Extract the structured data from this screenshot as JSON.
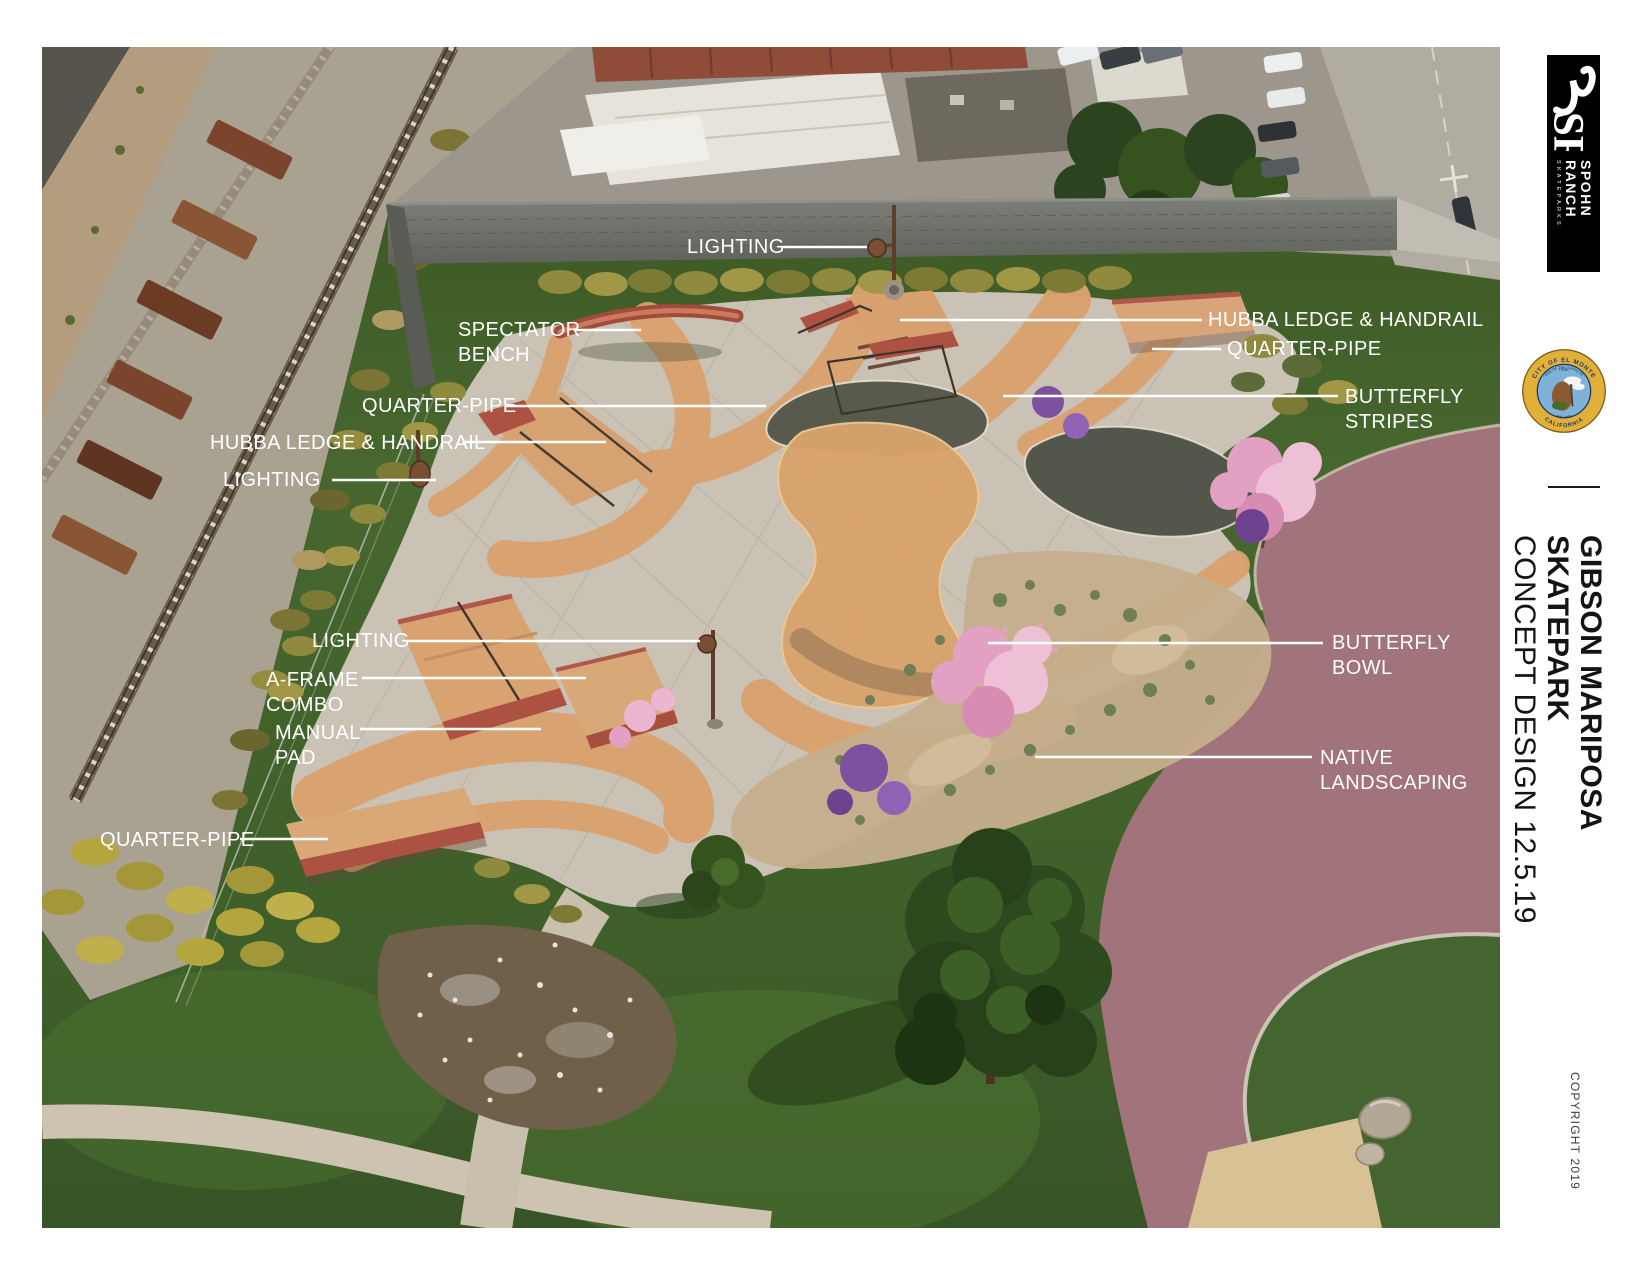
{
  "callouts": [
    {
      "id": "lighting-north",
      "label": "LIGHTING"
    },
    {
      "id": "spectator-bench",
      "label": "SPECTATOR\nBENCH"
    },
    {
      "id": "hubba-ledge-handrail-east",
      "label": "HUBBA LEDGE & HANDRAIL"
    },
    {
      "id": "quarter-pipe-east",
      "label": "QUARTER-PIPE"
    },
    {
      "id": "quarter-pipe-west",
      "label": "QUARTER-PIPE"
    },
    {
      "id": "butterfly-stripes",
      "label": "BUTTERFLY\nSTRIPES"
    },
    {
      "id": "hubba-ledge-handrail-west",
      "label": "HUBBA LEDGE & HANDRAIL"
    },
    {
      "id": "lighting-west",
      "label": "LIGHTING"
    },
    {
      "id": "lighting-south",
      "label": "LIGHTING"
    },
    {
      "id": "a-frame-combo",
      "label": "A-FRAME\nCOMBO"
    },
    {
      "id": "manual-pad",
      "label": "MANUAL\nPAD"
    },
    {
      "id": "butterfly-bowl",
      "label": "BUTTERFLY\nBOWL"
    },
    {
      "id": "native-landscaping",
      "label": "NATIVE\nLANDSCAPING"
    },
    {
      "id": "quarter-pipe-south",
      "label": "QUARTER-PIPE"
    }
  ],
  "sidebar": {
    "logo": {
      "monogram": "SR",
      "name_line1": "SPOHN",
      "name_line2": "RANCH",
      "tagline": "SKATEPARKS"
    },
    "seal": {
      "city": "CITY OF EL MONTE",
      "state": "CALIFORNIA",
      "motto": "END OF THE SANTA FE",
      "motto2": "TRAIL",
      "inc": "INC. 1912"
    },
    "title_line1": "GIBSON MARIPOSA SKATEPARK",
    "title_line2": "CONCEPT DESIGN 12.5.19",
    "copyright": "COPYRIGHT 2019"
  },
  "colors": {
    "label_text": "#ffffff",
    "leader_line": "#ffffff",
    "title_text": "#141414",
    "copyright_text": "#3c3c3c",
    "logo_background": "#000000",
    "seal_gold": "#e2af38",
    "seal_navy": "#1b3a66",
    "concrete": "#c9c2b5",
    "stripe_tan": "#daa26e",
    "feature_terracotta": "#b0584a",
    "path_mauve": "#a1737b",
    "lawn_green": "#44652e"
  }
}
